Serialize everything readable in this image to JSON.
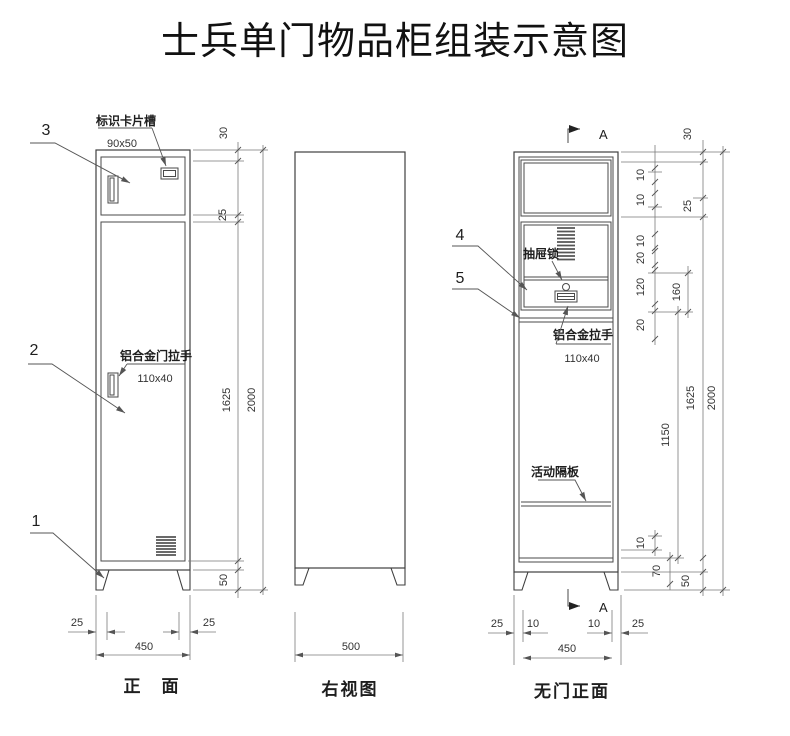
{
  "title": "士兵单门物品柜组装示意图",
  "front": {
    "label": "正　面",
    "balloons": {
      "b1": "1",
      "b2": "2",
      "b3": "3"
    },
    "card_slot": {
      "label": "标识卡片槽",
      "size": "90x50"
    },
    "door_handle": {
      "label": "铝合金门拉手",
      "size": "110x40"
    },
    "dims": {
      "top": "30",
      "gap": "25",
      "door_h": "1625",
      "total_h": "2000",
      "base_h": "50",
      "left": "25",
      "right": "25",
      "width": "450"
    }
  },
  "side": {
    "label": "右视图",
    "dims": {
      "depth": "500"
    }
  },
  "nodoor": {
    "label": "无门正面",
    "balloons": {
      "b4": "4",
      "b5": "5"
    },
    "drawer_lock": {
      "label": "抽屉锁"
    },
    "drawer_handle": {
      "label": "铝合金拉手",
      "size": "110x40"
    },
    "shelf": {
      "label": "活动隔板"
    },
    "section": {
      "letter": "A"
    },
    "dims": {
      "d10a": "10",
      "d10b": "10",
      "d10c": "10",
      "d20a": "20",
      "d120": "120",
      "d20b": "20",
      "d160": "160",
      "d1150": "1150",
      "d30": "30",
      "d25": "25",
      "d1625": "1625",
      "d2000": "2000",
      "d10d": "10",
      "d70": "70",
      "d50": "50",
      "b25l": "25",
      "b10l": "10",
      "b10r": "10",
      "b25r": "25",
      "width": "450"
    }
  }
}
